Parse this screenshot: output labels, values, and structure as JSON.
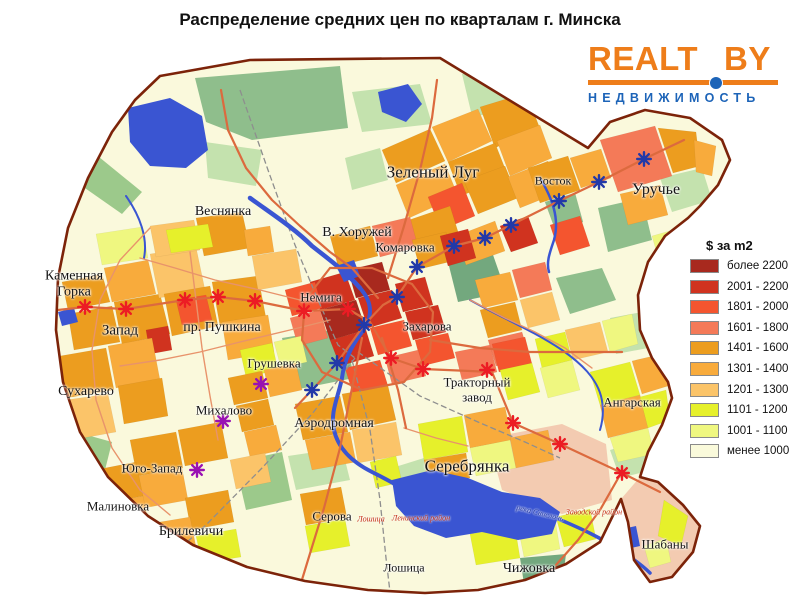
{
  "title": "Распределение средних цен по кварталам г. Минска",
  "logo": {
    "text1": "REALT",
    "text2": "BY",
    "subtitle": "НЕДВИЖИМОСТЬ",
    "orange": "#EE7D1A",
    "blue": "#1D64B8"
  },
  "legend": {
    "title": "$ за m2",
    "items": [
      {
        "label": "более 2200",
        "color": "#A8291E"
      },
      {
        "label": "2001 - 2200",
        "color": "#D0331F"
      },
      {
        "label": "1801 - 2000",
        "color": "#F4552F"
      },
      {
        "label": "1601 - 1800",
        "color": "#F47A58"
      },
      {
        "label": "1401 - 1600",
        "color": "#EC9D1F"
      },
      {
        "label": "1301 - 1400",
        "color": "#F8AB3C"
      },
      {
        "label": "1201 - 1300",
        "color": "#FBC469"
      },
      {
        "label": "1101 - 1200",
        "color": "#E6F02B"
      },
      {
        "label": "1001 - 1100",
        "color": "#EFF780"
      },
      {
        "label": "менее 1000",
        "color": "#FAFADB"
      }
    ]
  },
  "map": {
    "districts": [
      {
        "text": "Веснянка",
        "x": 223,
        "y": 212,
        "size": 14
      },
      {
        "text": "Зеленый Луг",
        "x": 433,
        "y": 172,
        "size": 17
      },
      {
        "text": "Восток",
        "x": 553,
        "y": 181,
        "size": 12
      },
      {
        "text": "Уручье",
        "x": 656,
        "y": 190,
        "size": 16
      },
      {
        "text": "В. Хоружей",
        "x": 357,
        "y": 233,
        "size": 14
      },
      {
        "text": "Комаровка",
        "x": 405,
        "y": 248,
        "size": 13
      },
      {
        "text": "Каменная\nГорка",
        "x": 74,
        "y": 284,
        "size": 14
      },
      {
        "text": "Немига",
        "x": 321,
        "y": 298,
        "size": 13
      },
      {
        "text": "Запад",
        "x": 120,
        "y": 331,
        "size": 15
      },
      {
        "text": "пр. Пушкина",
        "x": 222,
        "y": 328,
        "size": 14
      },
      {
        "text": "Захарова",
        "x": 427,
        "y": 327,
        "size": 13
      },
      {
        "text": "Грушевка",
        "x": 274,
        "y": 364,
        "size": 13
      },
      {
        "text": "Тракторный\nзавод",
        "x": 477,
        "y": 390,
        "size": 13
      },
      {
        "text": "Сухарево",
        "x": 86,
        "y": 392,
        "size": 14
      },
      {
        "text": "Михалово",
        "x": 224,
        "y": 411,
        "size": 13
      },
      {
        "text": "Ангарская",
        "x": 632,
        "y": 403,
        "size": 13
      },
      {
        "text": "Аэродромная",
        "x": 334,
        "y": 424,
        "size": 14
      },
      {
        "text": "Серебрянка",
        "x": 467,
        "y": 466,
        "size": 17
      },
      {
        "text": "Юго-Запад",
        "x": 152,
        "y": 469,
        "size": 13
      },
      {
        "text": "Малиновка",
        "x": 118,
        "y": 507,
        "size": 13
      },
      {
        "text": "Серова",
        "x": 332,
        "y": 517,
        "size": 13
      },
      {
        "text": "Брилевичи",
        "x": 191,
        "y": 532,
        "size": 14
      },
      {
        "text": "Лошица",
        "x": 404,
        "y": 568,
        "size": 12
      },
      {
        "text": "Чижовка",
        "x": 529,
        "y": 569,
        "size": 14
      },
      {
        "text": "Шабаны",
        "x": 665,
        "y": 545,
        "size": 13
      }
    ],
    "small_labels": [
      {
        "text": "Лошица",
        "x": 371,
        "y": 519,
        "size": 8,
        "color": "#C42A10",
        "rotate": 0
      },
      {
        "text": "Ленинский район",
        "x": 421,
        "y": 518,
        "size": 8,
        "color": "#C42A10",
        "rotate": 0
      },
      {
        "text": "река Свислочь",
        "x": 540,
        "y": 513,
        "size": 8,
        "color": "#2239A8",
        "rotate": 14
      },
      {
        "text": "Заводской район",
        "x": 594,
        "y": 512,
        "size": 8,
        "color": "#C42A10",
        "rotate": 0
      }
    ],
    "metro": {
      "lines": [
        {
          "name": "red-line",
          "color": "#EC1C24",
          "stations": [
            [
              85,
              307
            ],
            [
              126,
              309
            ],
            [
              185,
              300
            ],
            [
              218,
              297
            ],
            [
              255,
              301
            ],
            [
              304,
              311
            ],
            [
              348,
              309
            ],
            [
              391,
              358
            ],
            [
              423,
              369
            ],
            [
              487,
              370
            ],
            [
              513,
              423
            ],
            [
              560,
              444
            ],
            [
              622,
              473
            ]
          ]
        },
        {
          "name": "blue-line",
          "color": "#2239A8",
          "stations": [
            [
              312,
              390
            ],
            [
              337,
              363
            ],
            [
              364,
              325
            ],
            [
              397,
              297
            ],
            [
              417,
              267
            ],
            [
              454,
              246
            ],
            [
              485,
              238
            ],
            [
              511,
              225
            ],
            [
              559,
              201
            ],
            [
              599,
              182
            ],
            [
              644,
              159
            ]
          ]
        },
        {
          "name": "purple-line",
          "color": "#9911B3",
          "stations": [
            [
              261,
              384
            ],
            [
              223,
              421
            ],
            [
              197,
              470
            ]
          ]
        }
      ]
    }
  }
}
